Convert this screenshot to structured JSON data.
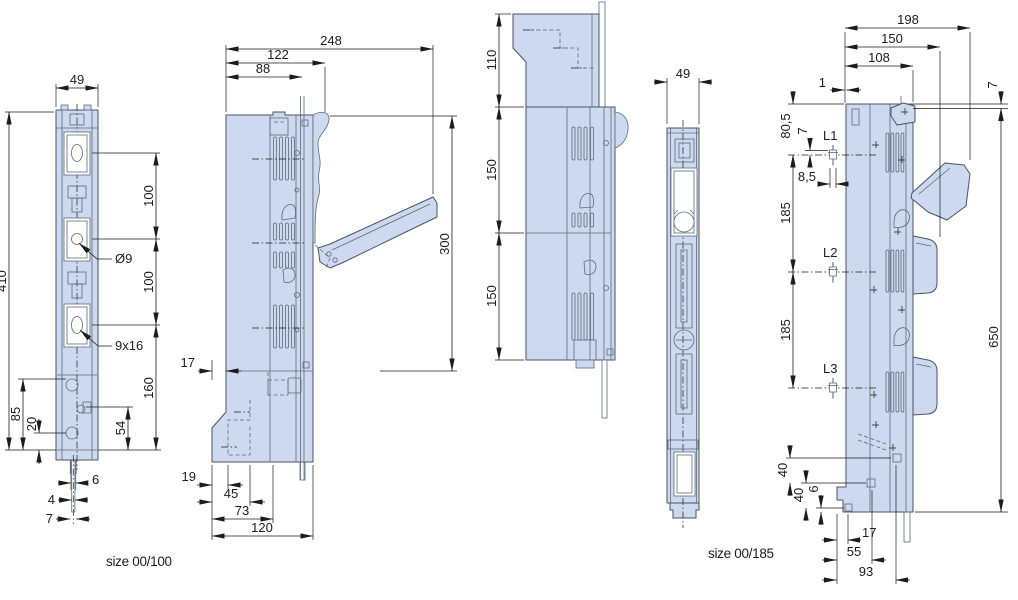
{
  "drawing": {
    "captions": {
      "left": "size 00/100",
      "right": "size 00/185"
    },
    "colors": {
      "bg": "#ffffff",
      "fill": "#ccd9ee",
      "stroke": "#4a5563",
      "detail": "#5f6b7a",
      "dim": "#1c1c1c",
      "white": "#ffffff"
    },
    "v1": {
      "w49": "49",
      "h410": "410",
      "p100a": "100",
      "p100b": "100",
      "d160": "160",
      "hole": "Ø9",
      "slot": "9x16",
      "d85": "85",
      "d20": "20",
      "d54": "54",
      "d6": "6",
      "d4": "4",
      "d7": "7"
    },
    "v2": {
      "d248": "248",
      "d122": "122",
      "d88": "88",
      "d300": "300",
      "d17": "17",
      "d19": "19",
      "d45": "45",
      "d73": "73",
      "d120": "120"
    },
    "v3": {
      "d110": "110",
      "d150a": "150",
      "d150b": "150"
    },
    "v4": {
      "w49": "49"
    },
    "v5": {
      "d198": "198",
      "d150": "150",
      "d108": "108",
      "d1": "1",
      "d7top": "7",
      "d80_5": "80,5",
      "d7l1": "7",
      "l1": "L1",
      "d8_5": "8,5",
      "d185a": "185",
      "l2": "L2",
      "d185b": "185",
      "l3": "L3",
      "d650": "650",
      "d40a": "40",
      "d40b": "40",
      "d6": "6",
      "d17": "17",
      "d55": "55",
      "d93": "93"
    }
  }
}
